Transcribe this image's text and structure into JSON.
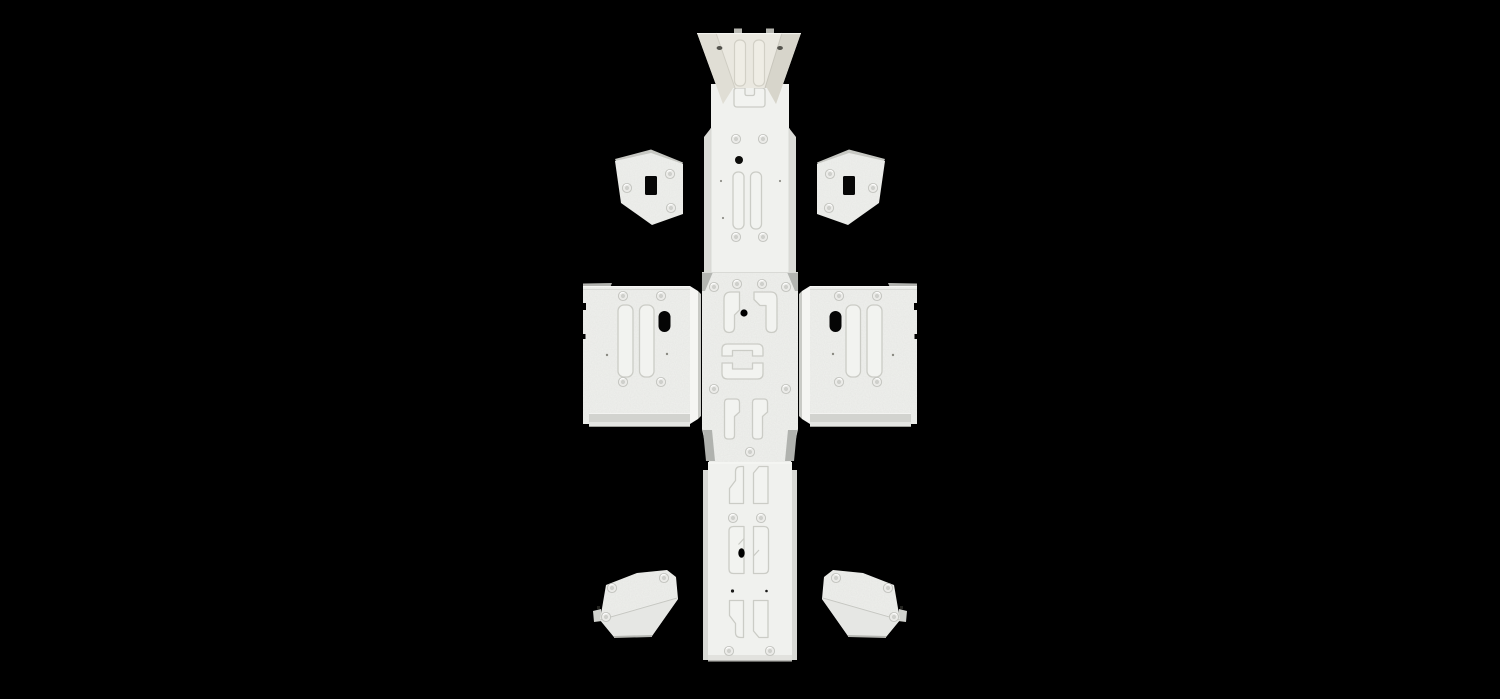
{
  "scene": {
    "type": "3d-product-render",
    "background": "#000000",
    "subject": "skid-plate-armor-kit-exploded-top-view"
  },
  "palette": {
    "background": "#000000",
    "plate": "#f0f1ee",
    "plate_bright": "#f5f5f3",
    "plate_warm": "#eae8e0",
    "wedge_left": "#e0ded5",
    "wedge_right": "#d7d5cb",
    "flange": "#d8d9d5",
    "bottom_flange": "#d2d3cf",
    "gusset": "#b3b5b1",
    "top_sliver": "#b2b3af",
    "tab_gray": "#b7b7b1",
    "bracket": "#eff0ed",
    "bracket_flange": "#e6e7e4",
    "hole": "#050505"
  },
  "parts": [
    {
      "name": "front-plate",
      "label": "front-bash-plate"
    },
    {
      "name": "spine-upper",
      "label": "main-spine-plate-upper"
    },
    {
      "name": "upper-bracket-left",
      "label": "upper-mounting-bracket-left"
    },
    {
      "name": "upper-bracket-right",
      "label": "upper-mounting-bracket-right"
    },
    {
      "name": "wing-plate-left",
      "label": "side-wing-plate-left"
    },
    {
      "name": "wing-plate-right",
      "label": "side-wing-plate-right"
    },
    {
      "name": "cross-center",
      "label": "center-belly-plate"
    },
    {
      "name": "spine-lower",
      "label": "main-spine-plate-lower"
    },
    {
      "name": "lower-bracket-left",
      "label": "lower-mounting-bracket-left"
    },
    {
      "name": "lower-bracket-right",
      "label": "lower-mounting-bracket-right"
    }
  ],
  "counts": {
    "bolt_holes": 25,
    "cutouts": 9
  }
}
